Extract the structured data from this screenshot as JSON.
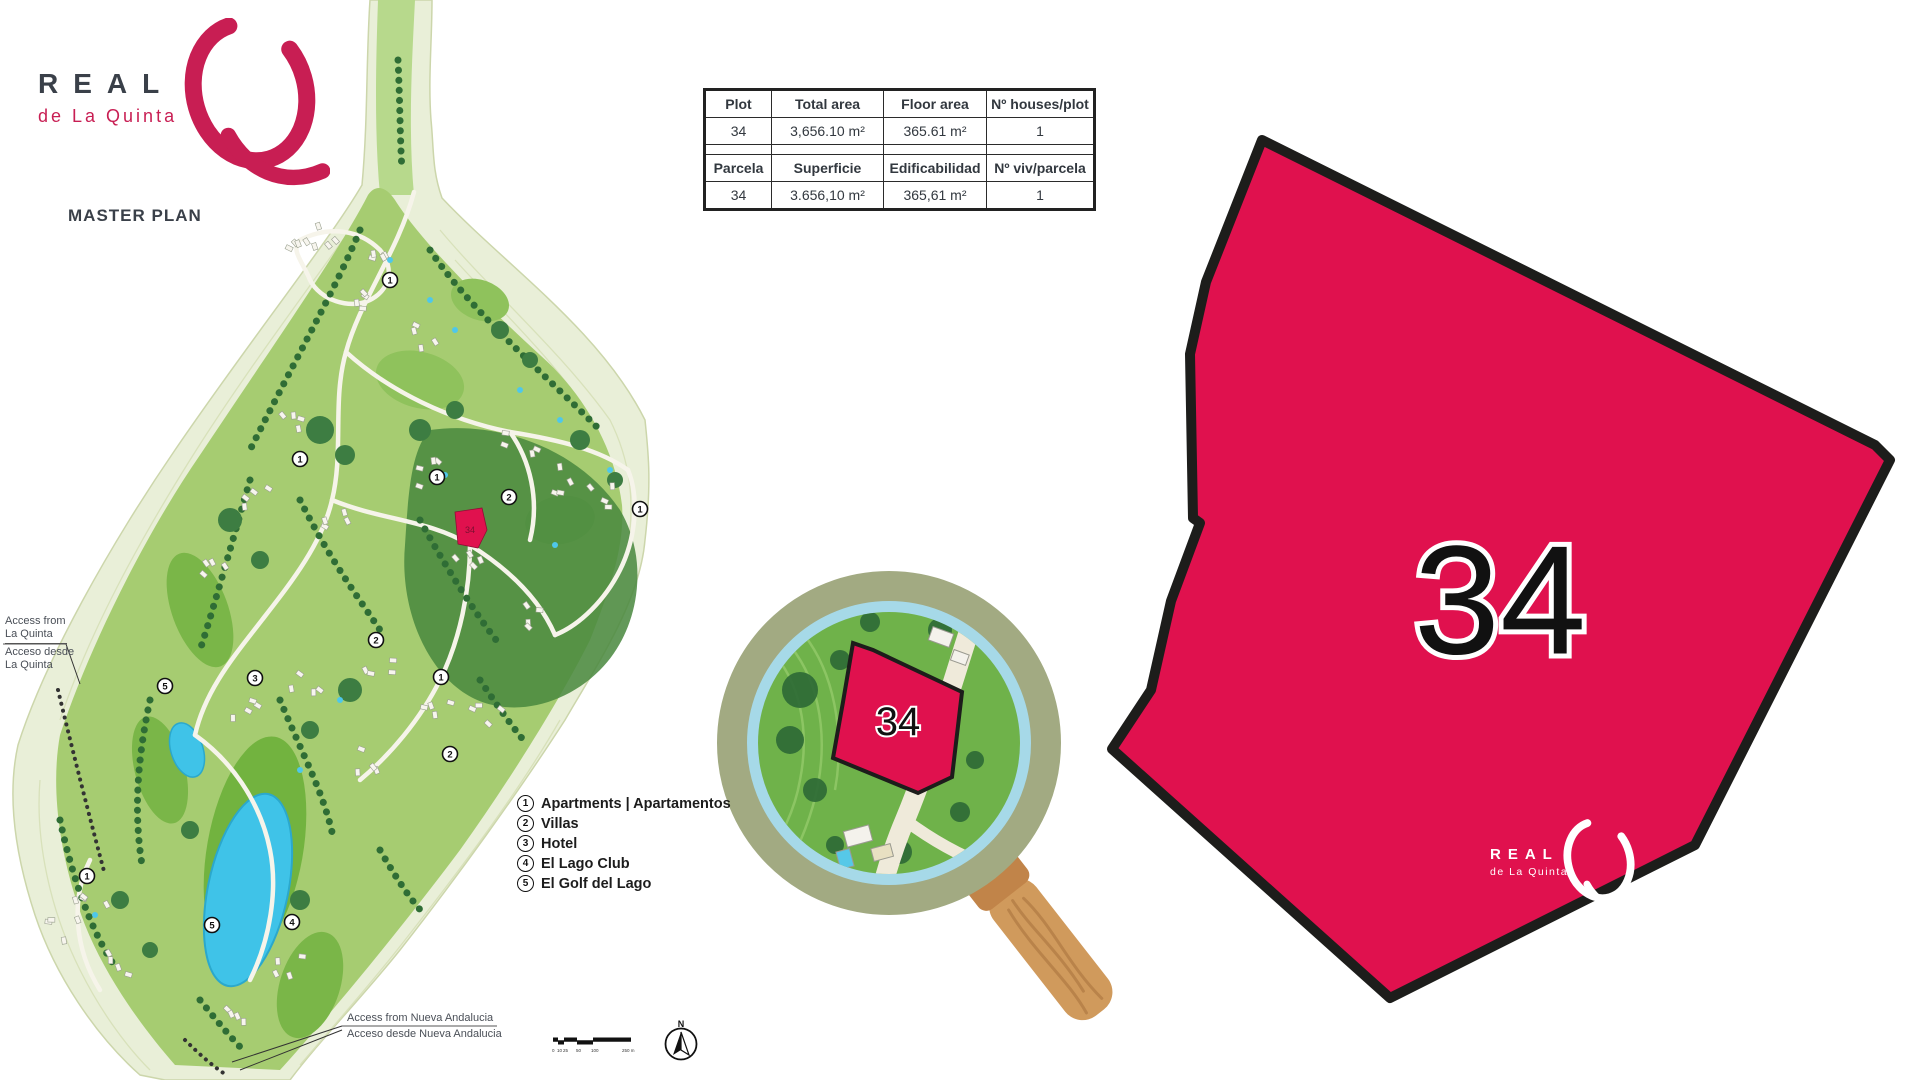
{
  "brand": {
    "name": "REAL",
    "subname": "de La Quinta",
    "title": "MASTER PLAN"
  },
  "table": {
    "en": {
      "headers": [
        "Plot",
        "Total area",
        "Floor area",
        "Nº houses/plot"
      ],
      "values": [
        "34",
        "3,656.10 m²",
        "365.61 m²",
        "1"
      ]
    },
    "es": {
      "headers": [
        "Parcela",
        "Superficie",
        "Edificabilidad",
        "Nº viv/parcela"
      ],
      "values": [
        "34",
        "3.656,10 m²",
        "365,61 m²",
        "1"
      ]
    }
  },
  "legend": {
    "items": [
      {
        "num": "1",
        "label": "Apartments | Apartamentos"
      },
      {
        "num": "2",
        "label": "Villas"
      },
      {
        "num": "3",
        "label": "Hotel"
      },
      {
        "num": "4",
        "label": "El Lago Club"
      },
      {
        "num": "5",
        "label": "El Golf del Lago"
      }
    ]
  },
  "access_la_quinta": {
    "en_line1": "Access from",
    "en_line2": "La Quinta",
    "es_line1": "Acceso desde",
    "es_line2": "La Quinta"
  },
  "access_nueva_andalucia": {
    "en": "Access from Nueva Andalucia",
    "es": "Acceso desde Nueva Andalucia"
  },
  "plot": {
    "number": "34"
  },
  "map": {
    "markers": [
      {
        "n": "1",
        "x": 390,
        "y": 280
      },
      {
        "n": "1",
        "x": 300,
        "y": 459
      },
      {
        "n": "1",
        "x": 437,
        "y": 477
      },
      {
        "n": "2",
        "x": 509,
        "y": 497
      },
      {
        "n": "1",
        "x": 640,
        "y": 509
      },
      {
        "n": "2",
        "x": 376,
        "y": 640
      },
      {
        "n": "3",
        "x": 255,
        "y": 678
      },
      {
        "n": "5",
        "x": 165,
        "y": 686
      },
      {
        "n": "1",
        "x": 441,
        "y": 677
      },
      {
        "n": "2",
        "x": 450,
        "y": 754
      },
      {
        "n": "1",
        "x": 87,
        "y": 876
      },
      {
        "n": "5",
        "x": 212,
        "y": 925
      },
      {
        "n": "4",
        "x": 292,
        "y": 922
      }
    ]
  },
  "compass": {
    "north": "N"
  },
  "scalebar": {
    "labels": [
      "0",
      "10",
      "25",
      "50",
      "100",
      "250 m"
    ]
  },
  "colors": {
    "brand_crimson": "#c81e53",
    "plot_crimson": "#e0114e",
    "dark_text": "#3a4049",
    "magnifier_ring": "#a2aa82",
    "wood": "#d09a5c",
    "map_green": "#a6cc71",
    "lake_blue": "#3fc3e8"
  }
}
